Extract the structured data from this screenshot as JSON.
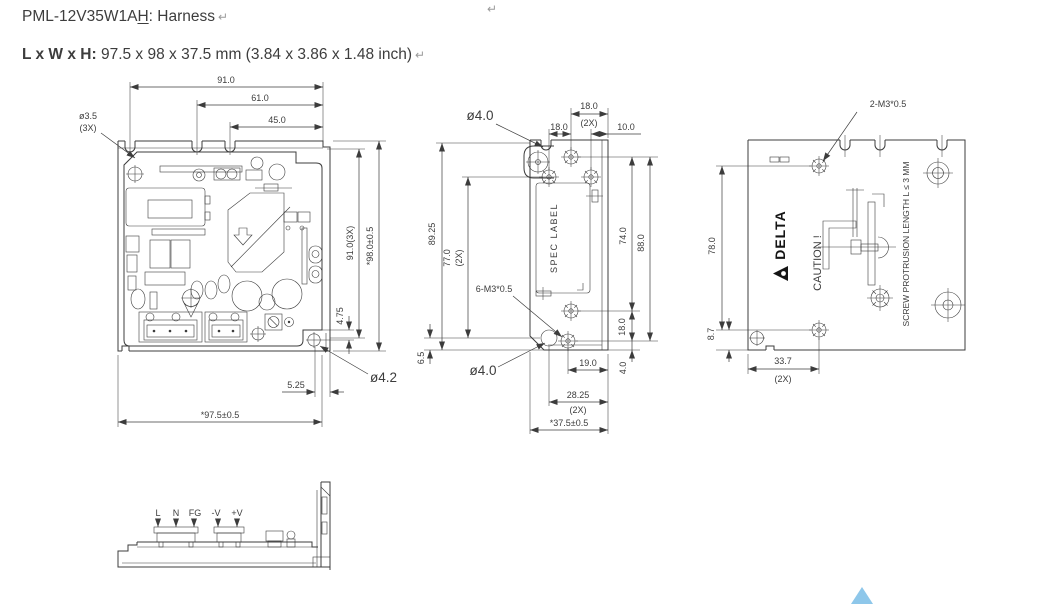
{
  "header": {
    "model": "PML-12V35W1A",
    "model_underlined": "H",
    "title_suffix": ": Harness",
    "size_label": "L x W x H:",
    "size_value": " 97.5 x 98 x 37.5 mm (3.84 x 3.86 x 1.48 inch)",
    "return_mark": "↵"
  },
  "colors": {
    "line": "#3c3c3c",
    "brand_black": "#151515",
    "paragraph_mark_gray": "#9a9a9a",
    "back_to_top_blue": "#8ec7ea"
  },
  "views": {
    "top": {
      "d91": "91.0",
      "d61": "61.0",
      "d45": "45.0",
      "hole3_dia": "ø3.5",
      "hole3_qty": "(3X)",
      "d91_3x": "91.0(3X)",
      "d98": "*98.0±0.5",
      "d4_75": "4.75",
      "hole42_dia": "ø4.2",
      "d5_25": "5.25",
      "d97_5": "*97.5±0.5"
    },
    "side": {
      "hole40_top": "ø4.0",
      "d18_pair": "18.0",
      "d18_pair_qty": "(2X)",
      "d18": "18.0",
      "d10": "10.0",
      "d89_25": "89.25",
      "d77": "77.0",
      "d77_qty": "(2X)",
      "spec_label": "SPEC LABEL",
      "thread6": "6-M3*0.5",
      "d74": "74.0",
      "d88": "88.0",
      "d18_right": "18.0",
      "d6_5": "6.5",
      "hole40_bottom": "ø4.0",
      "d19": "19.0",
      "d4": "4.0",
      "d28_25": "28.25",
      "d28_25_qty": "(2X)",
      "d37_5": "*37.5±0.5"
    },
    "back": {
      "thread2": "2-M3*0.5",
      "d78": "78.0",
      "d8_7": "8.7",
      "d33_7": "33.7",
      "d33_7_qty": "(2X)",
      "brand": "DELTA",
      "caution": "CAUTION !",
      "screw_note": "SCREW PROTRUSION LENGTH  L ≤ 3 MM"
    },
    "front": {
      "terminals": [
        "L",
        "N",
        "FG",
        "-V",
        "+V"
      ]
    }
  }
}
